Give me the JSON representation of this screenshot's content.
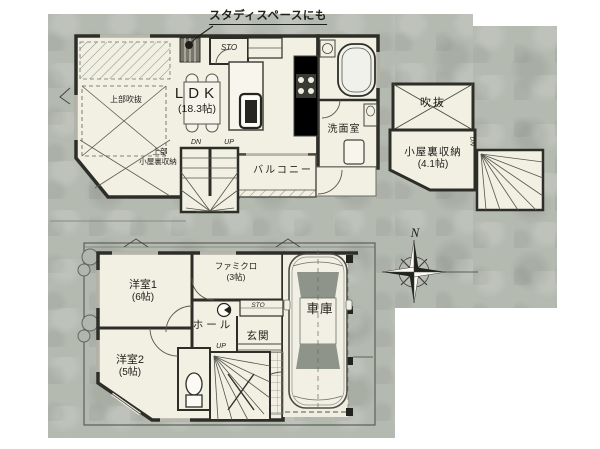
{
  "colors": {
    "paper_gray": "#b5bab1",
    "room_cream": "#f2f0e3",
    "wall_dark": "#2e2e29",
    "fixture_gray": "#8f948a"
  },
  "floor2": {
    "study_note": "スタディスペースにも",
    "sto": "STO",
    "ldk_name": "LDK",
    "ldk_size": "(18.3帖)",
    "void_upper": "上部吹抜",
    "attic_upper_line1": "上部",
    "attic_upper_line2": "小屋裏収納",
    "dn": "DN",
    "up": "UP",
    "balcony": "バルコニー",
    "washroom": "洗面室"
  },
  "attic": {
    "void": "吹抜",
    "storage_name": "小屋裏収納",
    "storage_size": "(4.1帖)",
    "dn": "DN"
  },
  "floor1": {
    "room1_name": "洋室1",
    "room1_size": "(6帖)",
    "famiclo_name": "ファミクロ",
    "famiclo_size": "(3帖)",
    "hall": "ホール",
    "entrance": "玄関",
    "sto": "STO",
    "room2_name": "洋室2",
    "room2_size": "(5帖)",
    "garage": "車庫",
    "up": "UP"
  },
  "compass": {
    "north": "N"
  }
}
